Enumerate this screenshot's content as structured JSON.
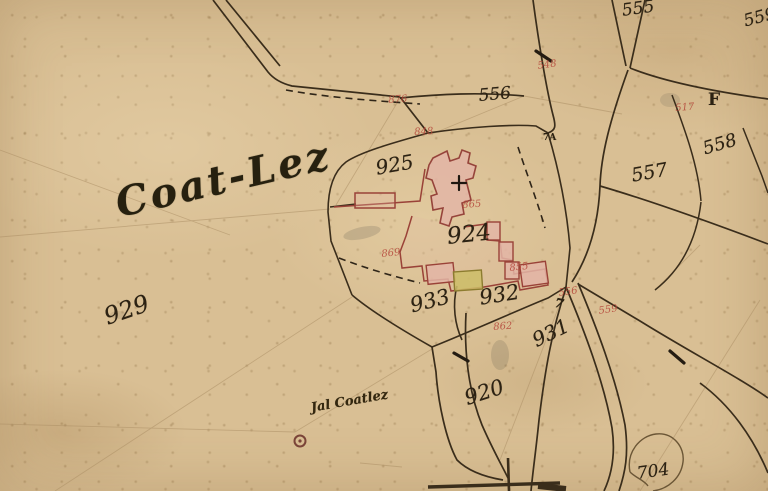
{
  "map": {
    "place_name": "Coat-Lez",
    "settlement_note": "Jal Coatlez",
    "section_letter": "F",
    "benchmark_label": "7A",
    "road_mark": "7"
  },
  "parcels_black": [
    {
      "id": "555",
      "text": "555"
    },
    {
      "id": "556",
      "text": "556"
    },
    {
      "id": "557",
      "text": "557"
    },
    {
      "id": "558",
      "text": "558"
    },
    {
      "id": "559",
      "text": "559"
    },
    {
      "id": "925",
      "text": "925"
    },
    {
      "id": "924",
      "text": "924"
    },
    {
      "id": "933",
      "text": "933"
    },
    {
      "id": "932",
      "text": "932"
    },
    {
      "id": "931",
      "text": "931"
    },
    {
      "id": "920",
      "text": "920"
    },
    {
      "id": "929",
      "text": "929"
    },
    {
      "id": "704",
      "text": "704"
    }
  ],
  "parcels_red": [
    {
      "id": "876",
      "text": "876"
    },
    {
      "id": "848",
      "text": "848"
    },
    {
      "id": "548",
      "text": "548"
    },
    {
      "id": "517",
      "text": "517"
    },
    {
      "id": "865",
      "text": "865"
    },
    {
      "id": "869",
      "text": "869"
    },
    {
      "id": "855",
      "text": "855"
    },
    {
      "id": "862",
      "text": "862"
    },
    {
      "id": "556",
      "text": "556"
    },
    {
      "id": "559",
      "text": "559"
    }
  ],
  "colors": {
    "parchment": "#d9bf94",
    "ink": "#2f2517",
    "red_ink": "#b5473a",
    "building_fill": "#e3b5a6",
    "building_stroke": "#9a4238",
    "outbuilding_fill": "#cdbd67",
    "outbuilding_stroke": "#8c7c2f"
  }
}
